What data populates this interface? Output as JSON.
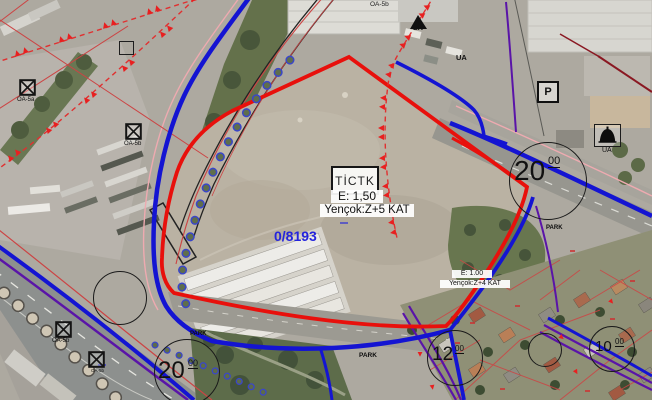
{
  "zone_card": {
    "code": "TİCTK",
    "emsal": "E: 1,50",
    "height": "Yençok:Z+5 KAT"
  },
  "parcel_number": "0/8193",
  "secondary_card": {
    "emsal": "E: 1.00",
    "height": "Yençok:Z+4 KAT"
  },
  "road_widths": {
    "right": {
      "main": "20",
      "sup": "00"
    },
    "bottom_left": {
      "main": "20",
      "sup": "00"
    },
    "bottom_center": {
      "main": "12",
      "sup": "00"
    },
    "bottom_right": {
      "main": "10",
      "sup": "00"
    }
  },
  "symbols": {
    "oa_top_center": "OA-5b",
    "oa_top_left": "OA-5a",
    "oa_mid_left": "OA-5b",
    "oa_bottom_left_1": "OA-5b",
    "oa_bottom_left_2": "OA-5b",
    "parking": "P",
    "mosque_label": "UA",
    "lk_label": "LK",
    "ua_small": "UA"
  },
  "park_labels": {
    "west": "PARK",
    "center": "PARK",
    "east": "PARK"
  },
  "colors": {
    "plan_blue": "#1414d2",
    "plan_red": "#e8100c",
    "plan_purple": "#5a14a8",
    "cadastral_red": "#cc4444",
    "parcel_text_blue": "#2424dd"
  }
}
